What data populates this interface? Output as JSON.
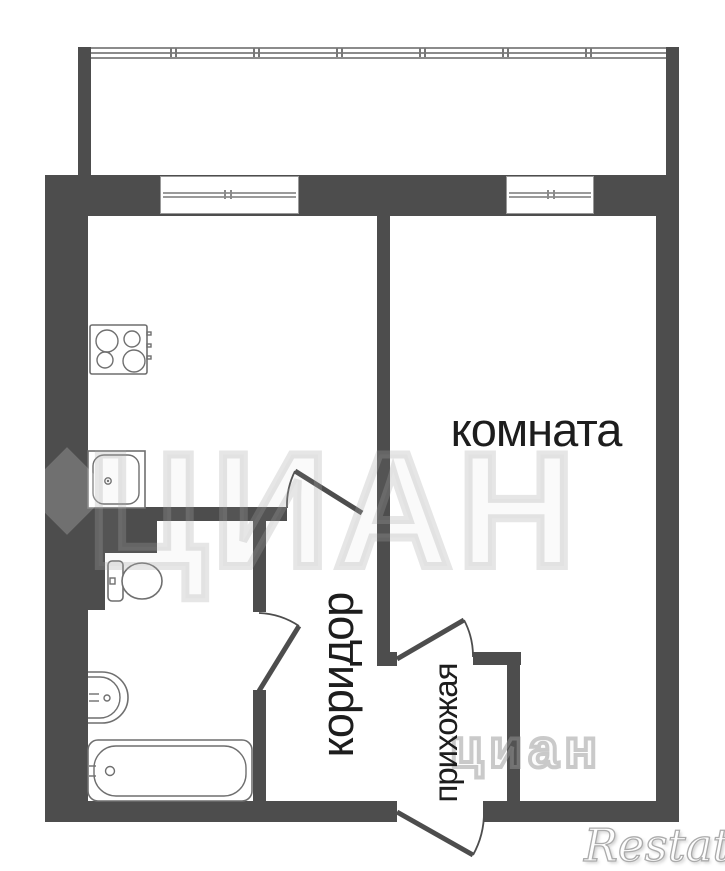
{
  "labels": {
    "room": "комната",
    "corridor": "коридор",
    "hallway": "прихожая"
  },
  "watermarks": {
    "center": "ЦИАН",
    "corner": "циан",
    "brand": "Restate"
  },
  "fixtures": [
    "stove-icon",
    "kitchen-sink-icon",
    "toilet-icon",
    "washbasin-icon",
    "bathtub-icon"
  ],
  "colors": {
    "wall": "#4d4d4d",
    "fixture_line": "#6f6f6f",
    "label": "#1d1d1d",
    "glazing": "#8b8b8b",
    "background": "#ffffff"
  }
}
